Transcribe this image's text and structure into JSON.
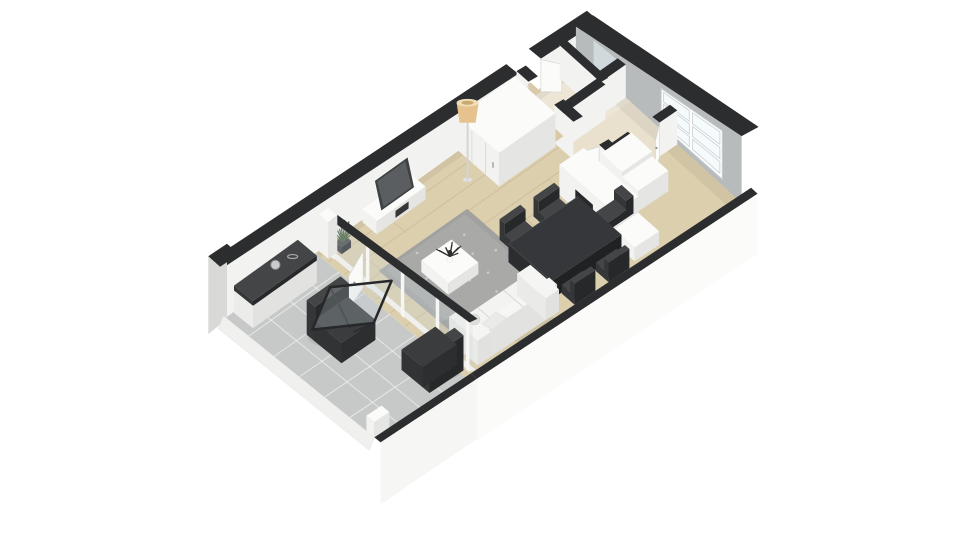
{
  "scene": {
    "type": "3d-floor-plan-isometric-render",
    "rooms": [
      "balcony",
      "living-room",
      "dining-area",
      "kitchen",
      "hallway",
      "bathroom",
      "closet"
    ],
    "furniture": [
      "sofa",
      "area-rug",
      "coffee-table",
      "tv-cabinet",
      "tv",
      "floor-lamp",
      "wardrobe",
      "media-wall-unit",
      "dining-table",
      "dining-chairs",
      "kitchen-cabinet",
      "balcony-sideboard",
      "lounge-chair",
      "glass-table",
      "balcony-armchair",
      "potted-plant"
    ]
  },
  "palette": {
    "bg": "#ffffff",
    "cap": "#2c2d2e",
    "wallLit": "#f2f2f1",
    "wallFaceSide": "#e8e8e6",
    "wallShadow": "#b8bbbc",
    "wallExt": "#fbfbfa",
    "wallExtBalc": "#f6f6f4",
    "wallExtSide": "#d9d9d7",
    "floorWood": "#dccfae",
    "woodLine": "#b7a27b",
    "floorTile": "#c7c9c8",
    "tileLine": "#ffffff",
    "floorHall": "#e9e1ce",
    "floorBath": "#ede6d7",
    "rug": "#a1a1a0",
    "rugLight": "#aeaeac",
    "furnTop": "#fbfbfa",
    "furnFace": "#f2f2f0",
    "furnSide": "#e5e5e3",
    "dark1": "#434547",
    "dark2": "#343638",
    "dark3": "#26282a",
    "tvScreen": "#5a5e61",
    "glass": "rgba(203,214,220,0.28)",
    "windowPane": "#f5fafc",
    "mullion": "#c9cfd2",
    "door": "#fbfbf9",
    "doorEdge": "#d2d2d0",
    "threshold": "#d9c9a6",
    "lampShade": "#e5c28e",
    "lampShadeTop": "#f2ddb5",
    "pole": "#d4d4d2",
    "plant": "#45603d",
    "plantDark": "#2d2f2b",
    "metal": "#c9ccce",
    "metalEdge": "#8d9193",
    "shadow": "rgba(0,0,0,0.07)"
  }
}
